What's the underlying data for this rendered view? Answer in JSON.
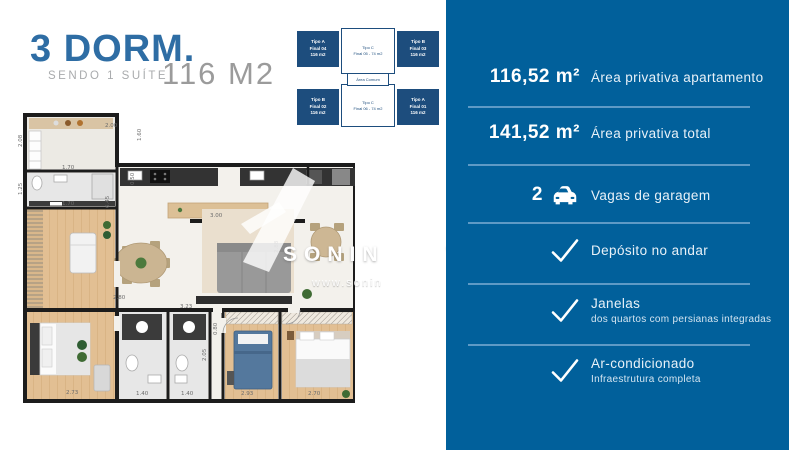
{
  "header": {
    "title": "3 DORM.",
    "subtitle": "SENDO 1 SUÍTE",
    "area": "116 M2"
  },
  "key_plan": {
    "corner_units": [
      {
        "line1": "Tipo A",
        "line2": "Final 04",
        "line3": "116 m2"
      },
      {
        "line1": "Tipo B",
        "line2": "Final 03",
        "line3": "116 m2"
      },
      {
        "line1": "Tipo B",
        "line2": "Final 02",
        "line3": "116 m2"
      },
      {
        "line1": "Tipo A",
        "line2": "Final 01",
        "line3": "116 m2"
      }
    ],
    "center_units": [
      {
        "line1": "Tipo C",
        "line2": "Final 05 - 74 m2"
      },
      {
        "line1": "Tipo C",
        "line2": "Final 06 - 74 m2"
      }
    ],
    "common_area": "Área Comum"
  },
  "floor_plan": {
    "dimensions": [
      "2.00",
      "1.60",
      "2.08",
      "1.70",
      "1.25",
      "1.70",
      "6.45",
      "0.50",
      "3.00",
      "2.88",
      "2.80",
      "3.23",
      "0.80",
      "2.05",
      "2.73",
      "1.40",
      "1.40",
      "2.93",
      "2.70"
    ]
  },
  "watermark": {
    "name_left": "SONIN",
    "name_right": "VEIS",
    "url_left": "www.sonin",
    "url_right": "m.br"
  },
  "specs": {
    "rows": [
      {
        "value": "116,52 m²",
        "label": "Área privativa apartamento"
      },
      {
        "value": "141,52 m²",
        "label": "Área privativa total"
      },
      {
        "value": "2",
        "label": "Vagas de garagem"
      },
      {
        "label": "Depósito no andar"
      },
      {
        "label": "Janelas",
        "sublabel": "dos quartos com persianas integradas"
      },
      {
        "label": "Ar-condicionado",
        "sublabel": "Infraestrutura completa"
      }
    ]
  },
  "colors": {
    "panel_blue": "#01609B",
    "title_blue": "#2E6DA4",
    "keyplan_blue": "#1D4D7D",
    "divider": "#5E9AC6"
  }
}
